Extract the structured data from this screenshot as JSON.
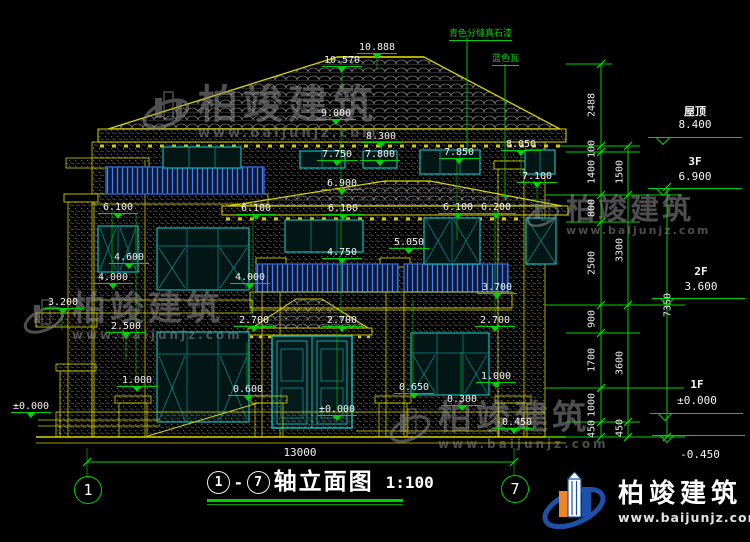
{
  "drawing": {
    "title": "轴立面图",
    "scale": "1:100",
    "axis_left": "1",
    "axis_right": "7",
    "span_dim": "13000"
  },
  "materials": [
    {
      "text": "青色分缝真石漆"
    },
    {
      "text": "蓝色瓦"
    }
  ],
  "marks": [
    {
      "v": "10.888",
      "x": 377,
      "y": 42
    },
    {
      "v": "10.570",
      "x": 342,
      "y": 55
    },
    {
      "v": "9.000",
      "x": 336,
      "y": 108
    },
    {
      "v": "8.300",
      "x": 381,
      "y": 131
    },
    {
      "v": "8.050",
      "x": 521,
      "y": 139
    },
    {
      "v": "7.750",
      "x": 337,
      "y": 149
    },
    {
      "v": "7.800",
      "x": 380,
      "y": 149
    },
    {
      "v": "7.850",
      "x": 459,
      "y": 147
    },
    {
      "v": "7.100",
      "x": 537,
      "y": 171
    },
    {
      "v": "6.900",
      "x": 342,
      "y": 178
    },
    {
      "v": "6.100",
      "x": 118,
      "y": 202
    },
    {
      "v": "6.100",
      "x": 256,
      "y": 203
    },
    {
      "v": "6.100",
      "x": 343,
      "y": 203
    },
    {
      "v": "6.100",
      "x": 458,
      "y": 202
    },
    {
      "v": "6.200",
      "x": 496,
      "y": 202
    },
    {
      "v": "5.050",
      "x": 409,
      "y": 237
    },
    {
      "v": "4.750",
      "x": 342,
      "y": 247
    },
    {
      "v": "4.600",
      "x": 129,
      "y": 252
    },
    {
      "v": "4.000",
      "x": 113,
      "y": 272
    },
    {
      "v": "4.000",
      "x": 250,
      "y": 272
    },
    {
      "v": "3.700",
      "x": 497,
      "y": 282
    },
    {
      "v": "3.200",
      "x": 63,
      "y": 297
    },
    {
      "v": "2.500",
      "x": 126,
      "y": 321
    },
    {
      "v": "2.700",
      "x": 254,
      "y": 315
    },
    {
      "v": "2.700",
      "x": 342,
      "y": 315
    },
    {
      "v": "2.700",
      "x": 495,
      "y": 315
    },
    {
      "v": "1.000",
      "x": 137,
      "y": 375
    },
    {
      "v": "1.000",
      "x": 496,
      "y": 371
    },
    {
      "v": "0.650",
      "x": 414,
      "y": 382
    },
    {
      "v": "0.600",
      "x": 248,
      "y": 384
    },
    {
      "v": "0.300",
      "x": 462,
      "y": 394
    },
    {
      "v": "±0.000",
      "x": 31,
      "y": 401
    },
    {
      "v": "±0.000",
      "x": 337,
      "y": 404
    },
    {
      "v": "-0.450",
      "x": 514,
      "y": 417
    }
  ],
  "levels": [
    {
      "name": "屋顶",
      "elev": "8.400",
      "x": 695,
      "ny": 103,
      "ey": 118,
      "sx": 648,
      "sy": 137,
      "sw": 94
    },
    {
      "name": "3F",
      "elev": "6.900",
      "x": 695,
      "ny": 155,
      "ey": 170,
      "sx": 648,
      "sy": 188,
      "sw": 94
    },
    {
      "name": "2F",
      "elev": "3.600",
      "x": 701,
      "ny": 265,
      "ey": 280,
      "sx": 652,
      "sy": 298,
      "sw": 93
    },
    {
      "name": "1F",
      "elev": "±0.000",
      "x": 697,
      "ny": 378,
      "ey": 394,
      "sx": 650,
      "sy": 413,
      "sw": 93
    },
    {
      "name": "",
      "elev": "-0.450",
      "x": 700,
      "ny": 0,
      "ey": 448,
      "sx": 652,
      "sy": 435,
      "sw": 93
    }
  ],
  "dims": {
    "outer": [
      {
        "v": "2488",
        "y": 105
      },
      {
        "v": "100",
        "y": 149
      },
      {
        "v": "1400",
        "y": 172
      },
      {
        "v": "800",
        "y": 208
      },
      {
        "v": "2500",
        "y": 263
      },
      {
        "v": "900",
        "y": 319
      },
      {
        "v": "1700",
        "y": 360
      },
      {
        "v": "1000",
        "y": 405
      },
      {
        "v": "450",
        "y": 429
      }
    ],
    "inner": [
      {
        "v": "1500",
        "y": 172
      },
      {
        "v": "3300",
        "y": 250
      },
      {
        "v": "3600",
        "y": 363
      },
      {
        "v": "450",
        "y": 428
      }
    ],
    "total": {
      "v": "7350",
      "x": 668,
      "y": 305
    }
  },
  "watermark": {
    "name": "柏竣建筑",
    "url": "www.baijunjz.com"
  },
  "brand": {
    "name": "柏竣建筑",
    "url": "www.baijunjz.com"
  }
}
